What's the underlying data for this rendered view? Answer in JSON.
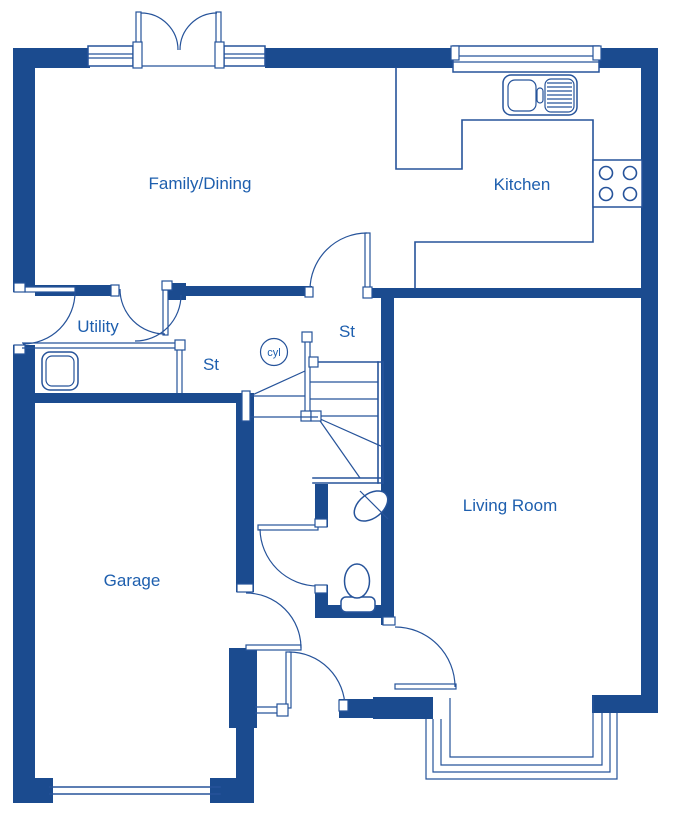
{
  "colors": {
    "wall": "#1b4b8f",
    "line": "#26539a",
    "text": "#1e5fae",
    "bg": "#ffffff"
  },
  "labels": {
    "family_dining": "Family/Dining",
    "kitchen": "Kitchen",
    "utility": "Utility",
    "store_hall": "St",
    "store_stairs": "St",
    "cylinder": "cyl",
    "garage": "Garage",
    "living_room": "Living Room"
  }
}
